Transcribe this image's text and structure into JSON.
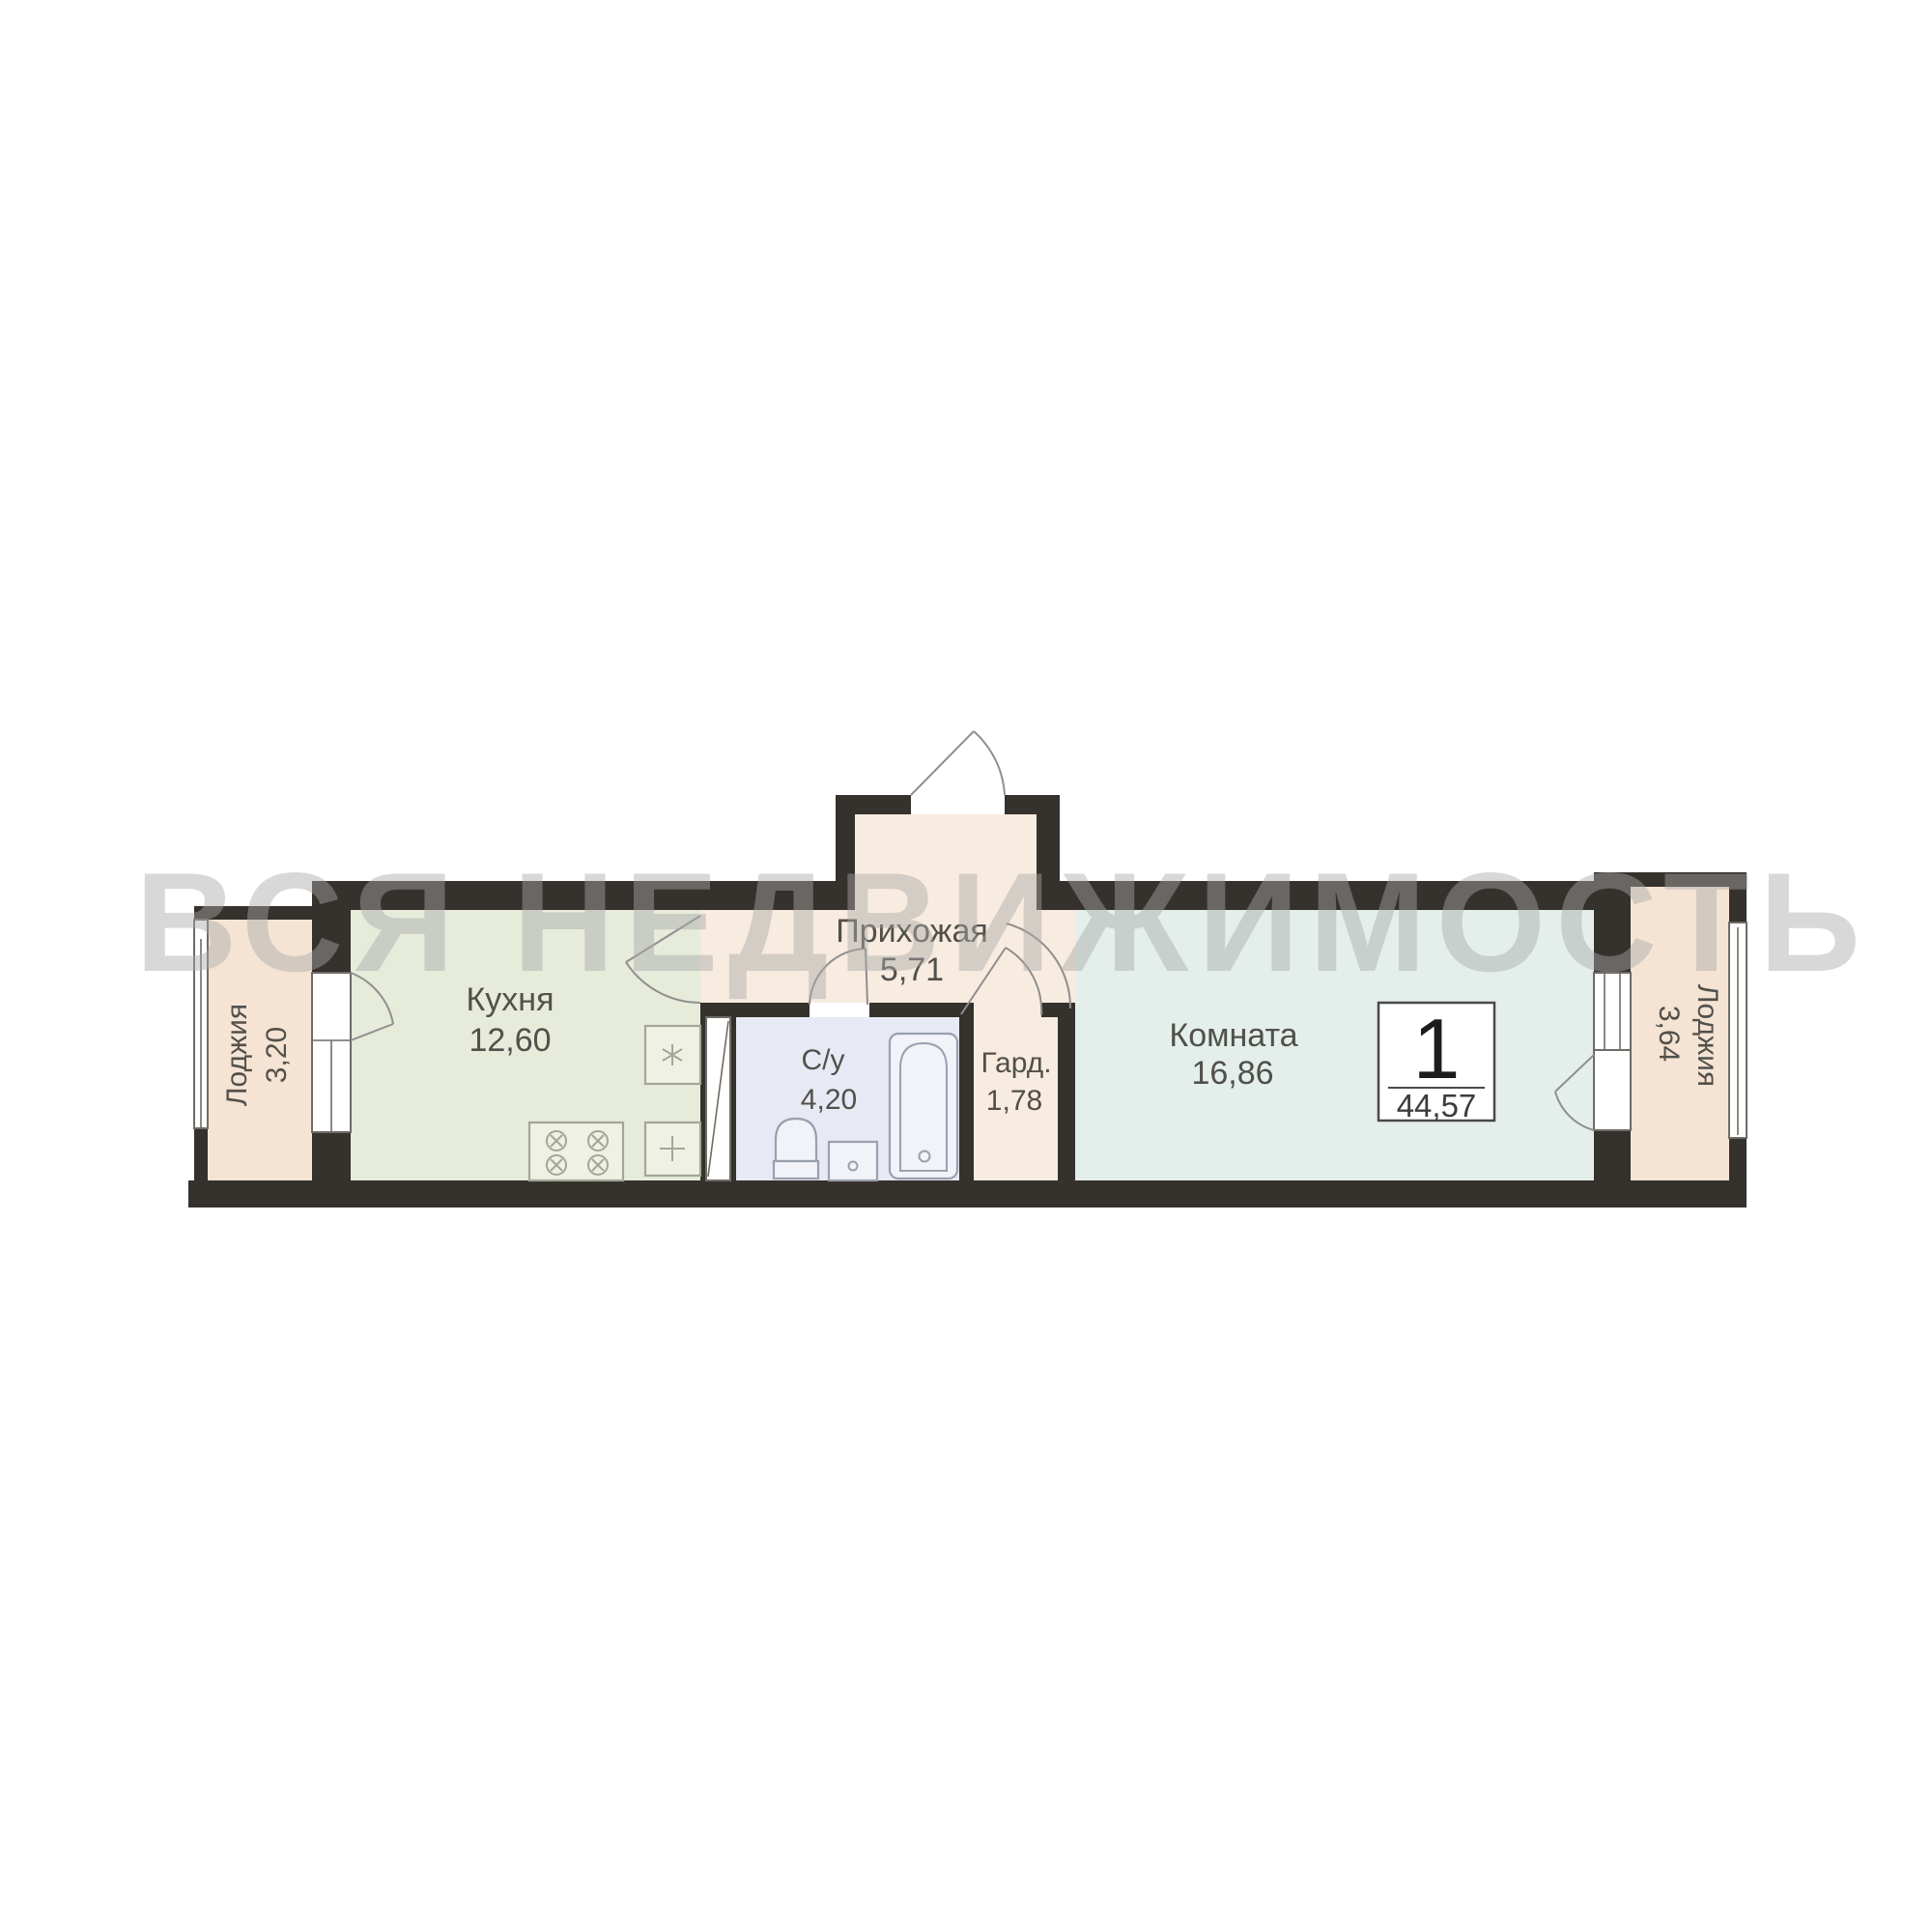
{
  "watermark": "ВСЯ НЕДВИЖИМОСТЬ",
  "badge": {
    "rooms": "1",
    "total_area": "44,57"
  },
  "rooms": {
    "loggia_left": {
      "name": "Лоджия",
      "area": "3,20"
    },
    "kitchen": {
      "name": "Кухня",
      "area": "12,60"
    },
    "hallway": {
      "name": "Прихожая",
      "area": "5,71"
    },
    "bathroom": {
      "name": "С/у",
      "area": "4,20"
    },
    "wardrobe": {
      "name": "Гард.",
      "area": "1,78"
    },
    "living_room": {
      "name": "Комната",
      "area": "16,86"
    },
    "loggia_right": {
      "name": "Лоджия",
      "area": "3,64"
    }
  },
  "colors": {
    "wall": "#35312c",
    "loggia": "#f5e3d3",
    "hall": "#f8ebdf",
    "kitchen": "#e6ebda",
    "bath": "#e7e9f4",
    "room": "#e4efeb",
    "fixfill": "#f2f3f9",
    "fixstroke": "#9aa0ae",
    "kfixfill": "#eef1e3",
    "kfixstroke": "#a3a795",
    "frame": "#6f6b66",
    "arc": "#8f8f8f",
    "label": "#51504b",
    "watermark": "#a9a9a9",
    "badge": "#4a4946"
  }
}
